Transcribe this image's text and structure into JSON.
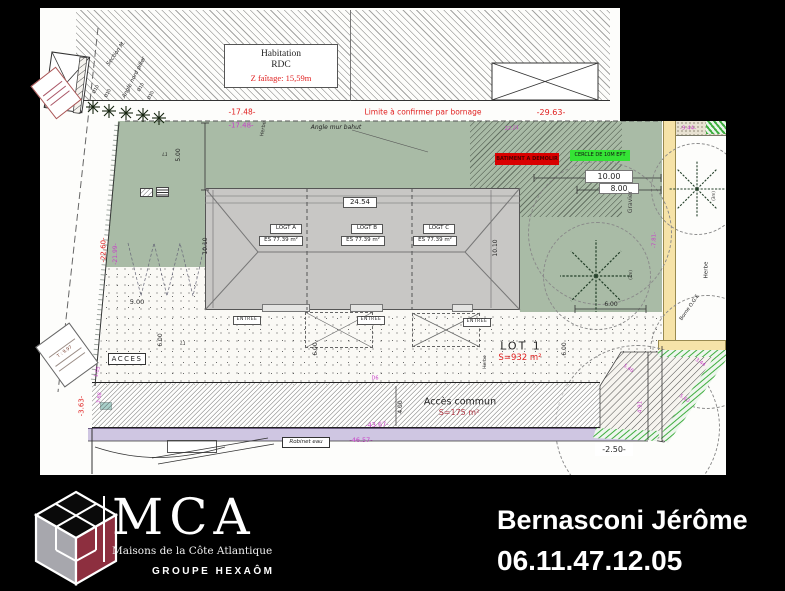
{
  "plan": {
    "top": {
      "habitation_1": "Habitation",
      "habitation_2": "RDC",
      "habitation_3": "Z faîtage: 15,59m",
      "limite": "Limite à confirmer par bornage",
      "dim_29_63": "-29.63-",
      "dim_17_48_red": "-17.48-",
      "dim_17_48_mag": "-17.48-",
      "angle_mur": "Angle mur bahut",
      "section_m": "Section M.",
      "angle_nord": "Angle nord pilier",
      "dia10": "Ø10",
      "dim_9_44": "-9.44-",
      "note_22_21": "22.21"
    },
    "garden": {
      "demolir": "BATIMENT A DEMOLIR",
      "cercle": "CERCLE DE 10M EPT",
      "dim_10_00": "10.00",
      "dim_8_00": "8.00",
      "gravier": "Gravier",
      "herbe": "Herbe"
    },
    "building": {
      "dim_24_54": "24.54",
      "units": [
        {
          "name": "LOGT A",
          "area": "ES 77.39 m²"
        },
        {
          "name": "LOGT B",
          "area": "ES 77.39 m²"
        },
        {
          "name": "LOGT C",
          "area": "ES 77.39 m²"
        }
      ],
      "dim_10_10": "10.10",
      "entree": "ENTREE"
    },
    "ground": {
      "lot_name": "LOT 1",
      "lot_surface": "S=932 m²",
      "acces": "ACCES",
      "acces_commun": "Accès commun",
      "acces_surface": "S=175 m²",
      "l1": "L1",
      "dim_5_00": "5.00",
      "dim_6_00": "6.00",
      "dim_4_00": "4.00",
      "d6": "D6"
    },
    "road": {
      "robinet": "Robinet eau",
      "dim_46_57": "-46.57-",
      "dim_43_67": "-43.67-",
      "dim_2_50": "-2.50-",
      "dim_3_63": "-3.63-"
    },
    "left": {
      "dim_22_60": "-22.60-",
      "dim_21_99": "-21.99-",
      "dim_1_05": "1.05",
      "dim_3_68": "3.68",
      "parcel_t": "T : 9.97"
    },
    "right": {
      "herbe": "Herbe",
      "borne": "Borne O.G.E",
      "m3": "(3m)",
      "dim_7_81": "-7.81-",
      "dim_3_44": "3.44",
      "dim_5_60": "5.60",
      "dim_5_46": "5.46",
      "dim_4_91": "4.91"
    }
  },
  "footer": {
    "brand": "MCA",
    "tagline": "Maisons de la Côte Atlantique",
    "group": "GROUPE HEXAÔM",
    "contact_name": "Bernasconi Jérôme",
    "contact_phone": "06.11.47.12.05"
  },
  "colors": {
    "garden_green": "#a9bba6",
    "roof_gray": "#c8c7c5",
    "accent_red": "#e02020",
    "magenta": "#c83fc8",
    "demolir_bg": "#d90000",
    "cercle_bg": "#35e335",
    "yellow_strip": "#f6e3a8",
    "purple_strip": "#cfc6e2",
    "logo_maroon": "#8d2f3f"
  }
}
